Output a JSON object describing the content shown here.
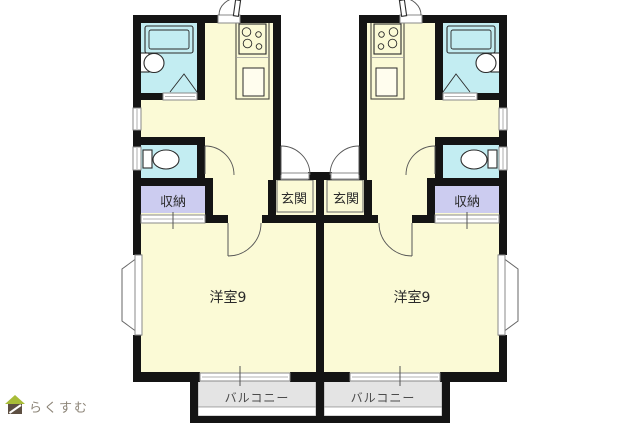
{
  "floor_plan": {
    "kind": "two-unit mirrored apartment floor plan",
    "units": [
      {
        "side": "left",
        "rooms": [
          {
            "name": "western-room",
            "label": "洋室9"
          },
          {
            "name": "entrance",
            "label": "玄関"
          },
          {
            "name": "storage",
            "label": "収納"
          },
          {
            "name": "balcony",
            "label": "バルコニー"
          }
        ],
        "fixtures": [
          "bathtub-icon",
          "washbasin-icon",
          "toilet-icon",
          "stove-burners-icon",
          "kitchen-sink-icon",
          "bay-window",
          "folding-door",
          "door-swing-arcs",
          "sliding-windows"
        ]
      },
      {
        "side": "right",
        "rooms": [
          {
            "name": "western-room",
            "label": "洋室9"
          },
          {
            "name": "entrance",
            "label": "玄関"
          },
          {
            "name": "storage",
            "label": "収納"
          },
          {
            "name": "balcony",
            "label": "バルコニー"
          }
        ],
        "fixtures": [
          "bathtub-icon",
          "washbasin-icon",
          "toilet-icon",
          "stove-burners-icon",
          "kitchen-sink-icon",
          "bay-window",
          "folding-door",
          "door-swing-arcs",
          "sliding-windows"
        ]
      }
    ]
  },
  "labels": {
    "room_left": "洋室9",
    "room_right": "洋室9",
    "entrance_left": "玄関",
    "entrance_right": "玄関",
    "storage_left": "収納",
    "storage_right": "収納",
    "balcony_left": "バルコニー",
    "balcony_right": "バルコニー"
  },
  "watermark": {
    "brand_text": "らくすむ",
    "icon": "house-icon"
  },
  "colors": {
    "pageBg": "#ffffff",
    "wall": "#141414",
    "floor": "#fbfad6",
    "wet": "#c3edf2",
    "storage": "#ccccf0",
    "balcony": "#e4e4e4",
    "labelDark": "#2a2a2a",
    "labelSoft": "#4c4c4c",
    "brandText": "#8d8578",
    "brandRoof": "#a8bc38",
    "brandBody": "#5d4f42"
  }
}
